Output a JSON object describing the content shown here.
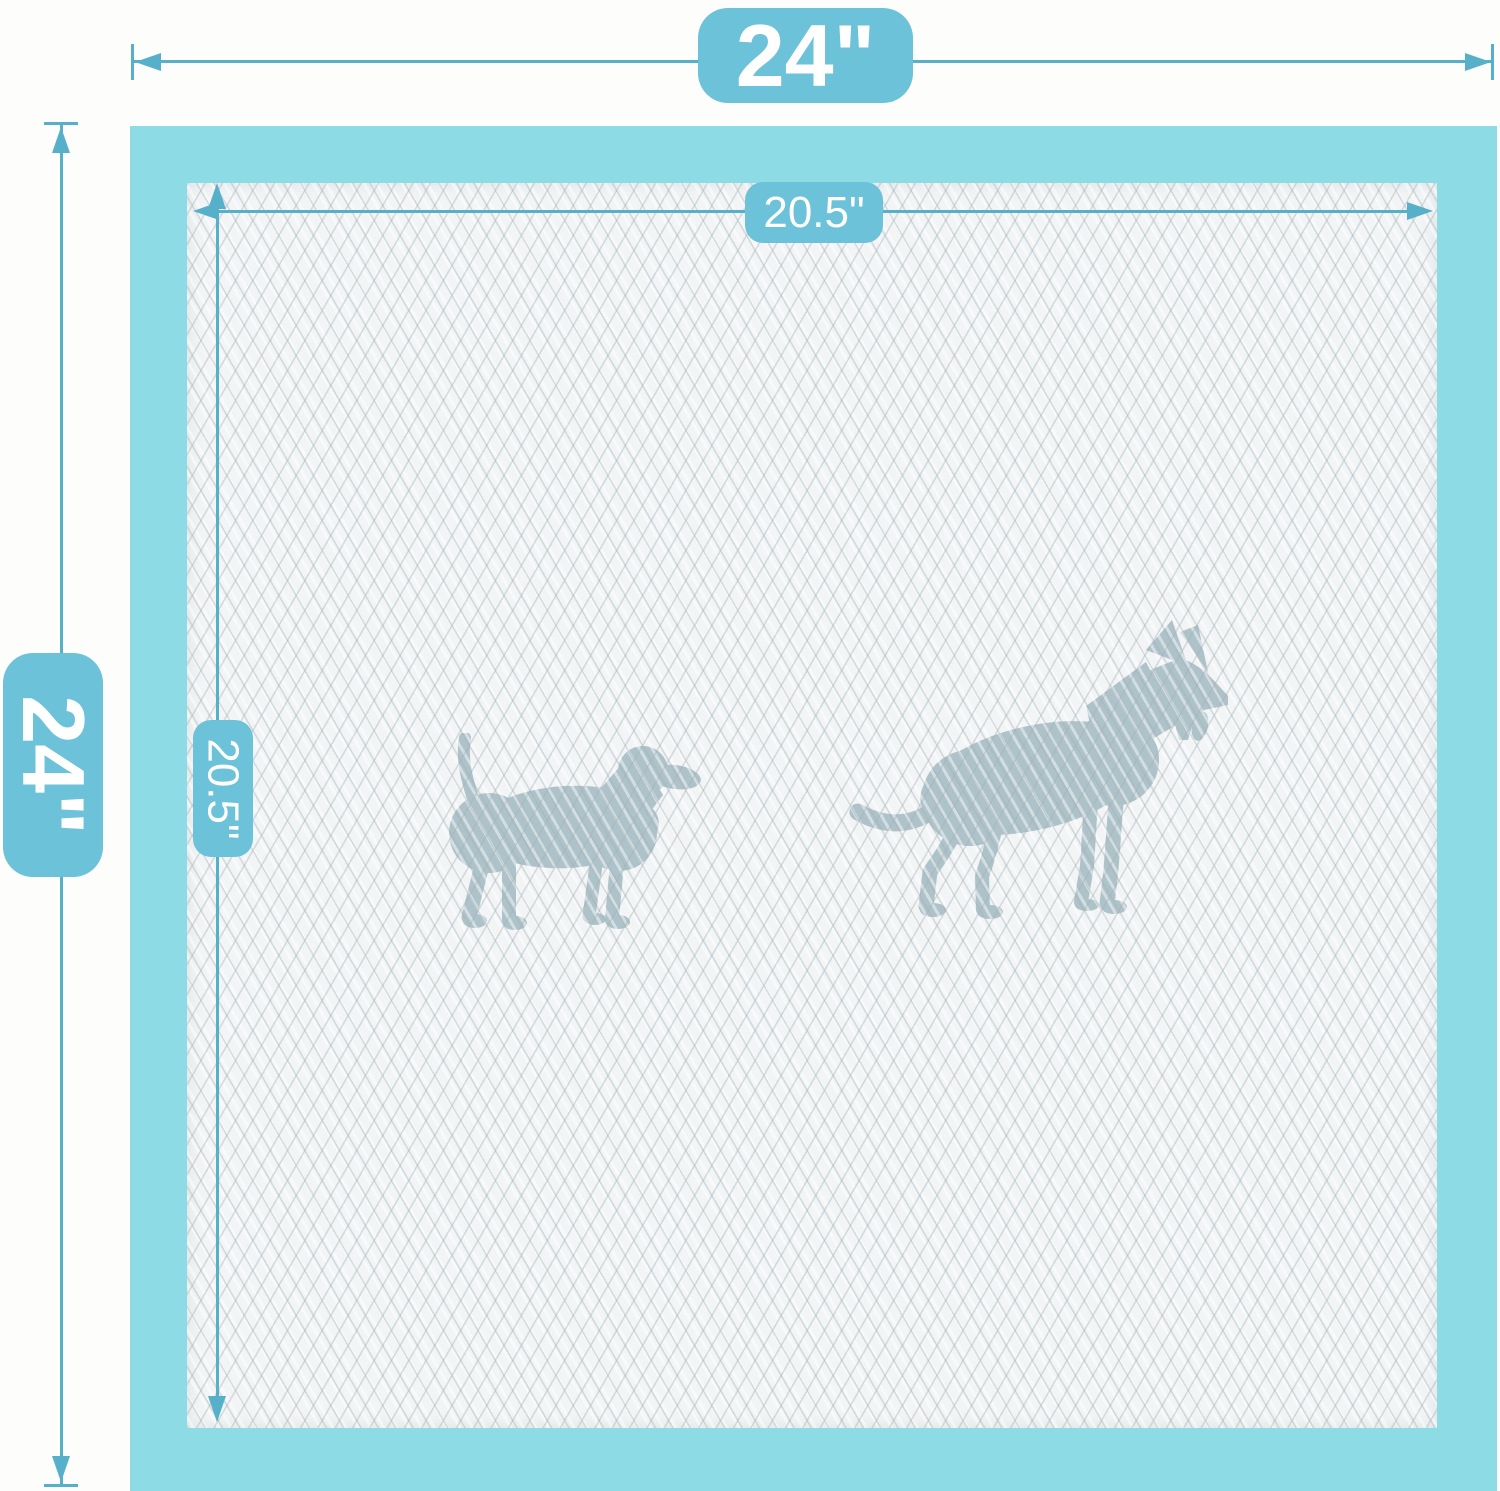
{
  "dimensions": {
    "outer_width": "24\"",
    "outer_height": "24\"",
    "inner_width": "20.5\"",
    "inner_height": "20.5\""
  },
  "colors": {
    "dimension_line": "#57b0ca",
    "dimension_label_bg": "#6cc2d8",
    "dimension_label_text": "#ffffff",
    "pad_border": "#8ddbe4",
    "pad_surface": "#f2f4f5",
    "quilt_line": "#c9d1d4",
    "dog_silhouette": "#adc2c9",
    "page_background": "#fdfdfb"
  },
  "icons": {
    "small_dog": "small-dog-silhouette",
    "large_dog": "large-dog-silhouette",
    "arrowheads": [
      "left-arrowhead-icon",
      "right-arrowhead-icon",
      "up-arrowhead-icon",
      "down-arrowhead-icon"
    ]
  }
}
